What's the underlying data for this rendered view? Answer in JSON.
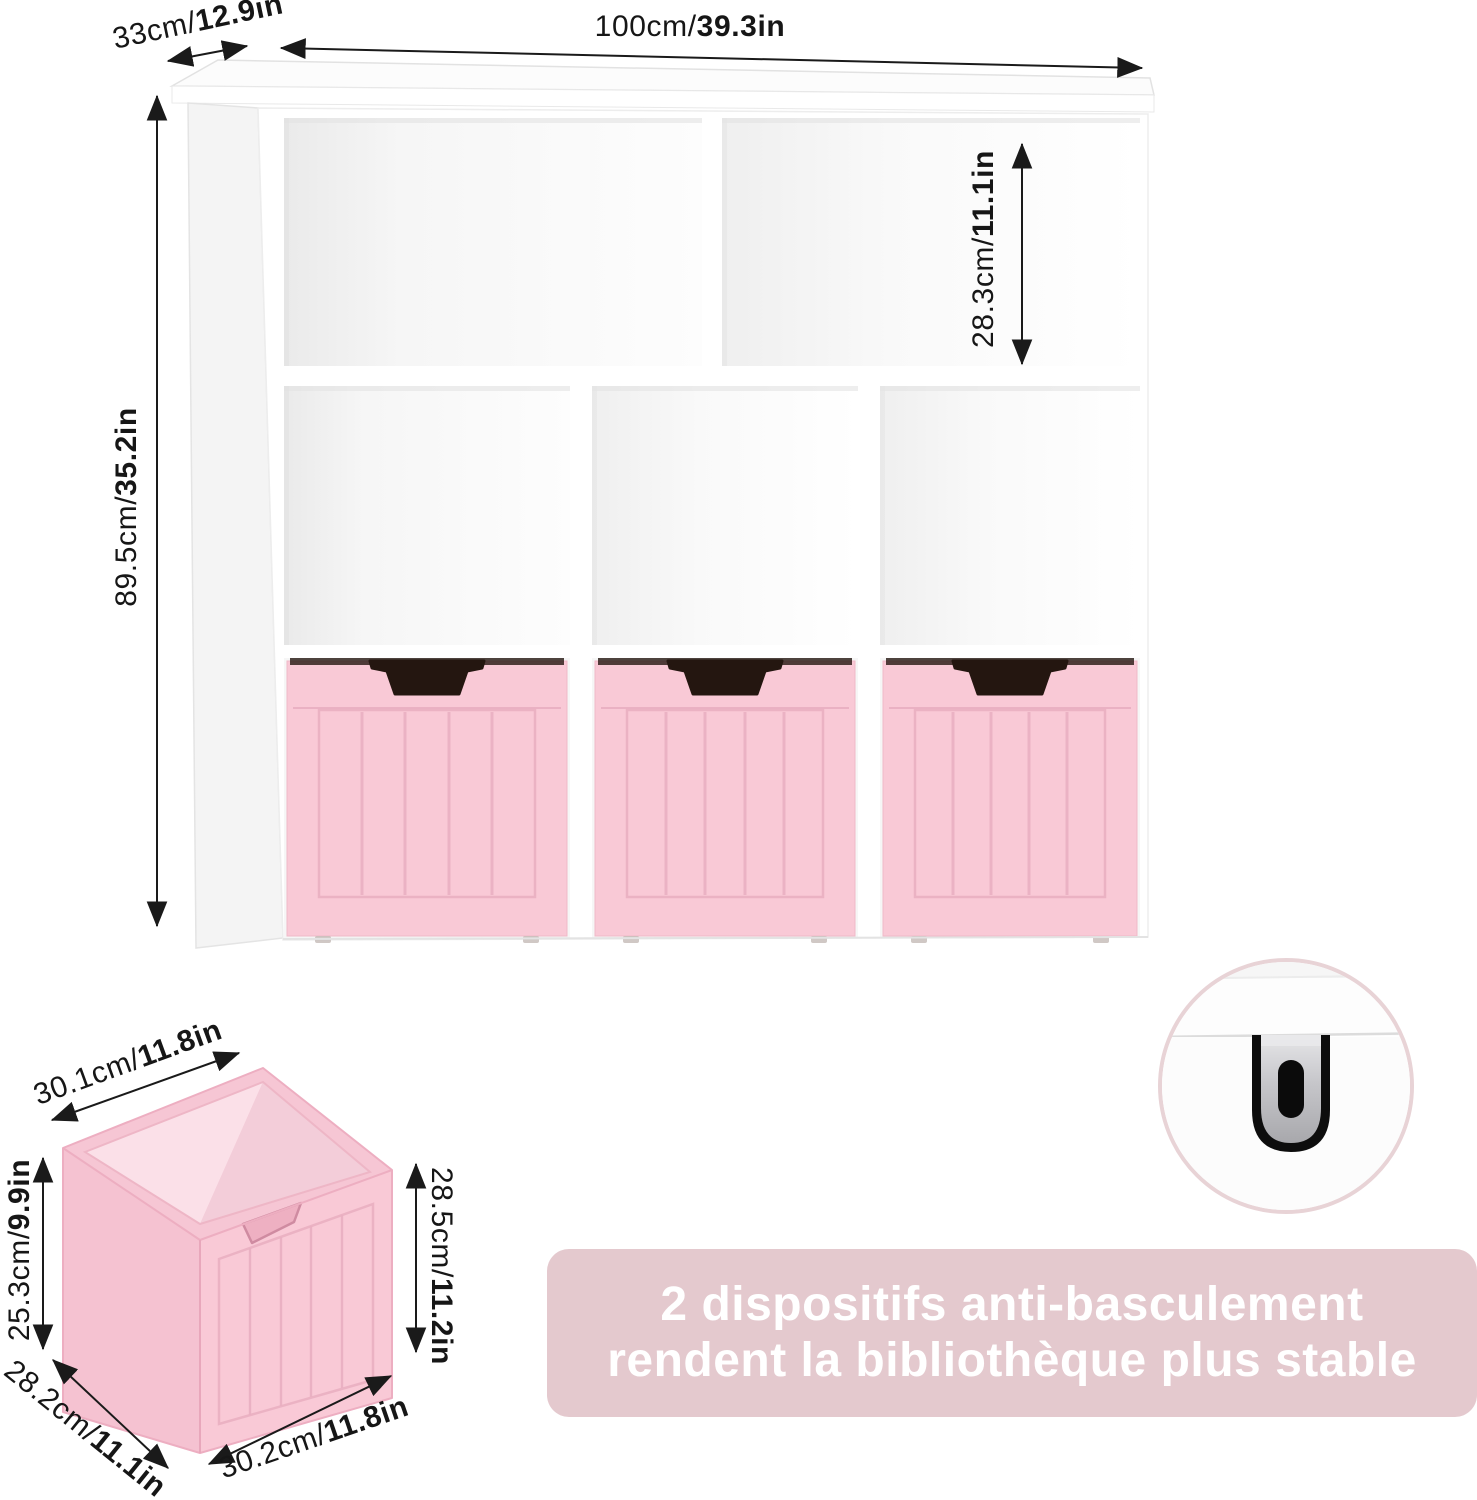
{
  "colors": {
    "drawer_pink": "#f9c9d6",
    "drawer_pink_dark": "#f5c2d1",
    "drawer_inner_light": "#fbe0e8",
    "drawer_inner_shaded": "#f3cdd9",
    "drawer_rim": "#f6c6d4",
    "drawer_line": "#e9afc1",
    "notch_dark": "#241610",
    "banner_pink": "#e4c9ce",
    "banner_text": "#ffffff",
    "circle_border": "#e8d3d6",
    "bracket_metal": "#c7c7cb",
    "arrow_color": "#1a1a1a"
  },
  "bookcase": {
    "dimensions": {
      "depth": {
        "metric": "33cm/",
        "imperial": "12.9in"
      },
      "width": {
        "metric": "100cm/",
        "imperial": "39.3in"
      },
      "cubby_height": {
        "metric": "28.3cm/",
        "imperial": "11.1in"
      },
      "height": {
        "metric": "89.5cm/",
        "imperial": "35.2in"
      }
    }
  },
  "drawer_box": {
    "dimensions": {
      "top_width": {
        "metric": "30.1cm/",
        "imperial": "11.8in"
      },
      "left_height": {
        "metric": "25.3cm/",
        "imperial": "9.9in"
      },
      "depth": {
        "metric": "28.2cm/",
        "imperial": "11.1in"
      },
      "bottom_width": {
        "metric": "30.2cm/",
        "imperial": "11.8in"
      },
      "right_height": {
        "metric": "28.5cm/",
        "imperial": "11.2in"
      }
    }
  },
  "stability_banner": {
    "line1": "2 dispositifs anti-basculement",
    "line2": "rendent la bibliothèque plus stable"
  },
  "icons": {
    "dimension_arrow": "double-headed-arrow",
    "anti_tip_bracket": "metal-anti-tip-bracket"
  }
}
